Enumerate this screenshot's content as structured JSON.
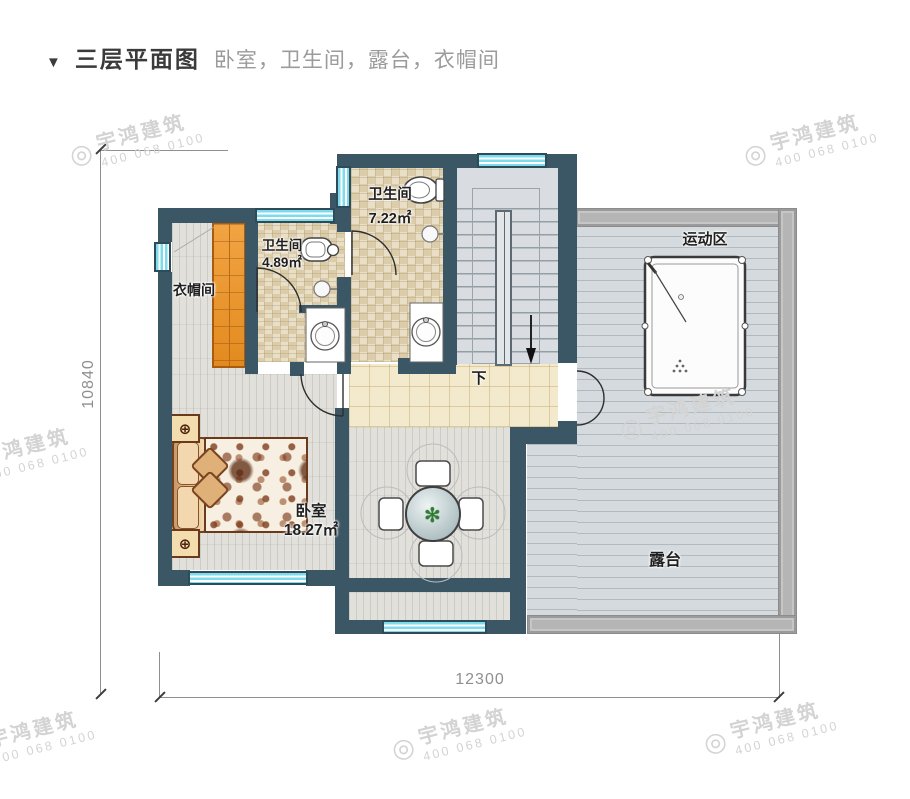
{
  "title": {
    "marker": "▼",
    "main": "三层平面图",
    "subtitle": "卧室，卫生间，露台，衣帽间"
  },
  "rooms": {
    "cloakroom": {
      "label": "衣帽间"
    },
    "bath_small": {
      "label": "卫生间",
      "area": "4.89㎡"
    },
    "bath_large": {
      "label": "卫生间",
      "area": "7.22㎡"
    },
    "bedroom": {
      "label": "卧室",
      "area": "18.27㎡"
    },
    "sports": {
      "label": "运动区"
    },
    "terrace": {
      "label": "露台"
    },
    "stairs": {
      "down_label": "下"
    }
  },
  "dimensions": {
    "height": "10840",
    "width": "12300"
  },
  "watermark": {
    "logo_glyph": "◎",
    "brand": "宇鸿建筑",
    "phone": "400 068 0100"
  },
  "icons": {
    "plant": "✻",
    "compass": "⊕"
  },
  "colors": {
    "wall": "#3b5665",
    "window_cyan": "#7edbee",
    "wardrobe_orange": "#ef9a38",
    "corridor_beige": "#f3eacd",
    "bath_tile": "#e9dfc6",
    "plank_gray": "#e1e0db",
    "terrace_gray": "#d4dadd",
    "parapet": "#b5b5b5",
    "dim_gray": "#8f8f8f"
  }
}
